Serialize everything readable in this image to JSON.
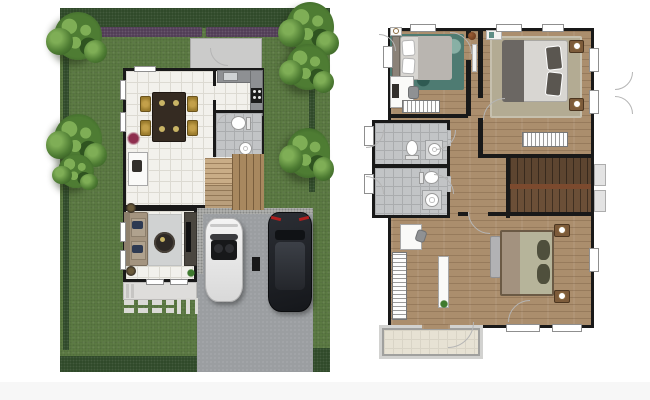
{
  "palette": {
    "lawn": "#5d7c44",
    "hedge": "#2c4726",
    "shrub": "#4e3953",
    "tree": "#4e7c33",
    "tree_hi": "#7fae56",
    "tree_dk": "#2f5420",
    "driveway": "#9b9ea1",
    "gravel": "#b5b6b3",
    "concrete": "#cbcbca",
    "stone": "#dadad5",
    "wall": "#191919",
    "tile_white": "#f2f1ec",
    "tile_line": "#dcdad2",
    "tile_gray": "#c2c4c6",
    "tile_gray_line": "#aaacae",
    "wood": "#ab8e6d",
    "stair_light": "#c9ad87",
    "stair_mid": "#a8885f",
    "stair_dark": "#5d4530",
    "landing": "#7c4a2e",
    "rug_teal": "#4e7b72",
    "rug_teal_dk": "#2f5a52",
    "rug_beige": "#b3ab93",
    "rug_gray": "#d0d2d2",
    "bed_white": "#d8d6d2",
    "bed_gray_throw": "#6b6763",
    "bed_sage": "#b6b49a",
    "bed_taupe": "#a3927f",
    "pillow_dark": "#4f4f3c",
    "headboard": "#8b8278",
    "sofa": "#a4947f",
    "sofa_back": "#8d7f6c",
    "pillow_blue": "#2e3a52",
    "coffee_table": "#2e2925",
    "tv_console": "#4a463f",
    "dining_table": "#352b22",
    "chair_gold": "#9c7d2e",
    "car_white": "#eaeaea",
    "car_black": "#21242a",
    "car_roof": "#3c4047",
    "taillight": "#b11f1f",
    "car_interior": "#17181a",
    "balcony": "#e7e2d4",
    "railing": "#a0a09e",
    "plant_red": "#8e2e4e",
    "plant_green": "#3e7a2e",
    "arc": "#b5b5b5",
    "nightstand": "#7d5b3a"
  },
  "plans": [
    {
      "id": "first-floor-site-plan",
      "features": [
        "lawn",
        "top-hedge",
        "shrub-row",
        "trees",
        "dining-room",
        "kitchen",
        "bathroom",
        "staircase",
        "living-room",
        "terrace",
        "stepping-stones",
        "driveway",
        "carport",
        "white-convertible-car",
        "black-suv-car",
        "side-concrete-pad"
      ]
    },
    {
      "id": "second-floor-plan",
      "features": [
        "front-bedroom",
        "master-bedroom",
        "upper-bathroom",
        "lower-bathroom",
        "staircase",
        "hallway",
        "rear-bedroom",
        "wardrobes",
        "balcony",
        "windows"
      ]
    }
  ]
}
